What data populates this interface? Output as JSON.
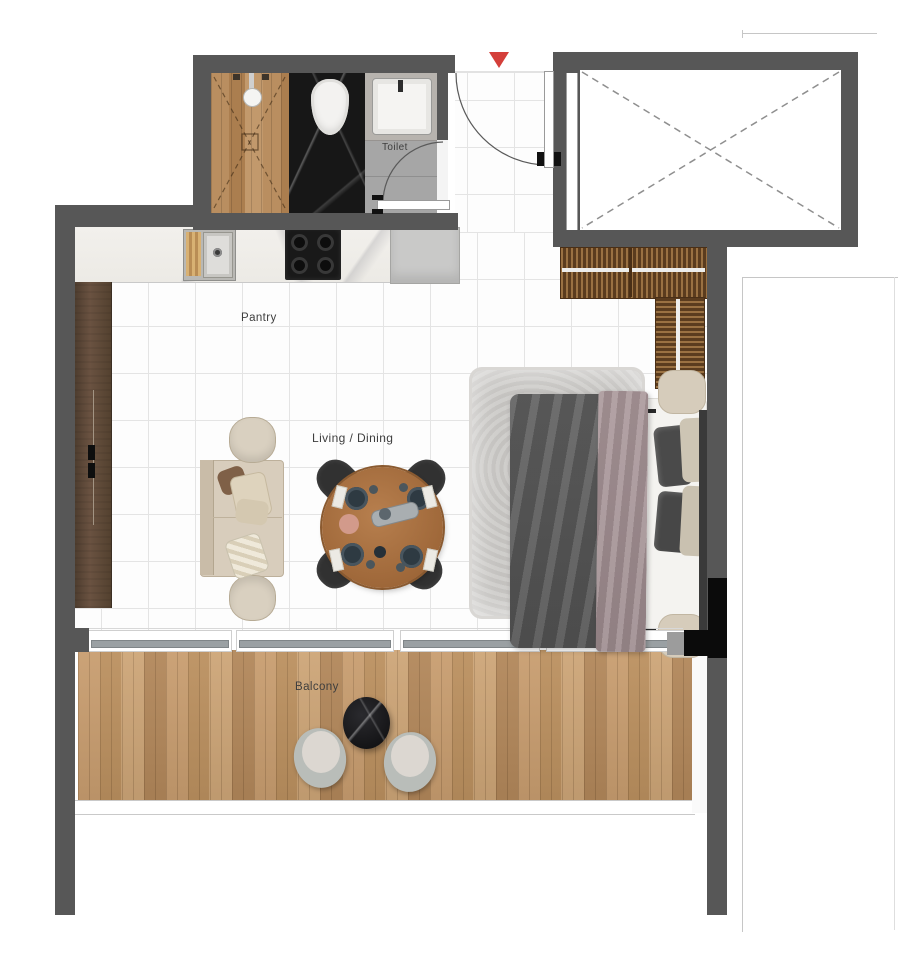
{
  "plan": {
    "type": "floor-plan",
    "labels": {
      "toilet": "Toilet",
      "pantry": "Pantry",
      "living_dining": "Living / Dining",
      "balcony": "Balcony"
    },
    "colors": {
      "wall": "#575757",
      "entry_marker": "#d43f3a",
      "shower_wood": "#b2875a",
      "dark_marble": "#171717",
      "toilet_floor": "#a6a6a6",
      "kitchen_counter_marble": "#f1efeb",
      "hob": "#1a1a1a",
      "cabinet_wood": "#5f4937",
      "wardrobe_wood": "#6b4626",
      "deck_wood": "#c49a6e",
      "rug": "#cac8c5",
      "duvet": "#5d5d5d",
      "throw_blanket": "#a39193",
      "sofa": "#d8cdbc",
      "dining_table_wood": "#a8703f",
      "dining_chair": "#313131",
      "balcony_table_marble": "#1c1c1f",
      "pouf": "#d6ccbb"
    },
    "furniture": [
      "walk-in-shower",
      "toilet-wc",
      "wash-basin",
      "kitchen-sink",
      "gas-hob",
      "refrigerator",
      "tall-cabinet",
      "l-shaped-wardrobe",
      "sofa",
      "armchair-top",
      "armchair-bottom",
      "round-dining-table",
      "dining-chair-x4",
      "double-bed",
      "area-rug",
      "bedside-pouf-x2",
      "balcony-table",
      "balcony-chair-x2",
      "elevator-void",
      "entry-door",
      "toilet-door",
      "sliding-glass-doors"
    ]
  }
}
